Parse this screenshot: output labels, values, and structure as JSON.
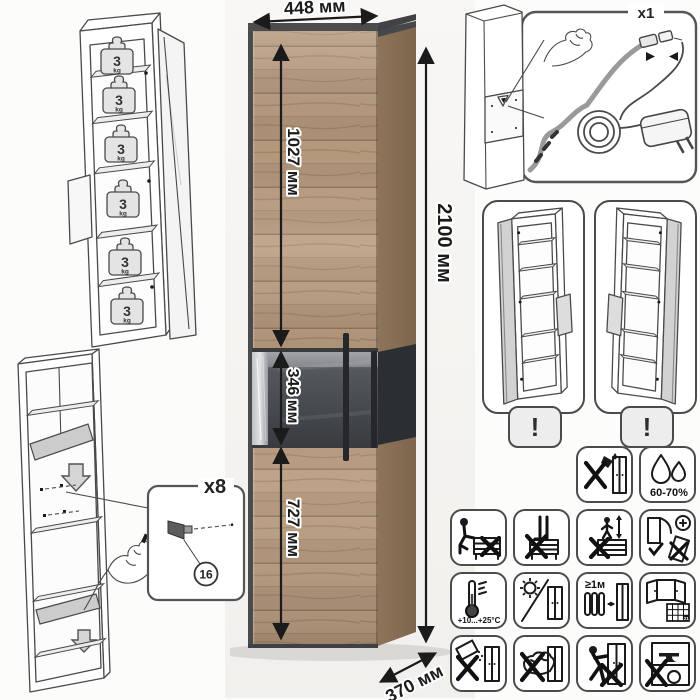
{
  "dimensions": {
    "width": "448 мм",
    "height": "2100 мм",
    "depth": "370 мм",
    "upper_door": "1027 мм",
    "niche": "346 мм",
    "lower_door": "727 мм"
  },
  "shelf_load": {
    "value": "3",
    "unit": "kg"
  },
  "led_kit": {
    "qty": "x1"
  },
  "door_options": {
    "warning": "!"
  },
  "assembly": {
    "qty": "x8",
    "part": "16"
  },
  "care": {
    "humidity": "60-70%",
    "temperature": "+10...+25°C",
    "heater_distance": "≥1м",
    "calendar_day": "21"
  },
  "colors": {
    "wood": "#b3967a",
    "frame": "#4b4c4e",
    "niche": "#3c3f42",
    "line_art": "#4a4a4a"
  }
}
